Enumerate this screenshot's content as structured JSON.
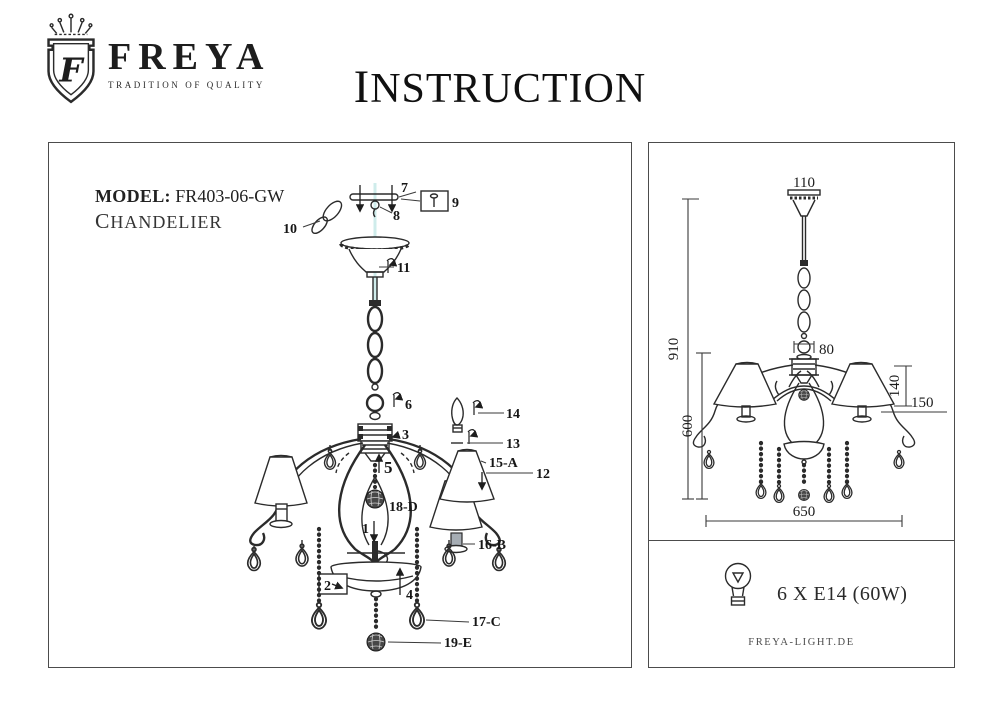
{
  "brand": {
    "monogram": "F",
    "name": "FREYA",
    "tagline": "TRADITION OF QUALITY"
  },
  "title": "INSTRUCTION",
  "product": {
    "model_label": "MODEL:",
    "model_value": "FR403-06-GW",
    "type": "CHANDELIER"
  },
  "exploded_view": {
    "parts": {
      "p1": "1",
      "p2": "2",
      "p3": "3",
      "p4": "4",
      "p5": "5",
      "p6": "6",
      "p7": "7",
      "p8": "8",
      "p9": "9",
      "p10": "10",
      "p11": "11",
      "p12": "12",
      "p13": "13",
      "p14": "14",
      "p15a": "15-A",
      "p16b": "16-B",
      "p17c": "17-C",
      "p18d": "18-D",
      "p19e": "19-E"
    }
  },
  "dimension_view": {
    "canopy_diameter": "110",
    "overall_height": "910",
    "hub_width": "80",
    "shade_height": "140",
    "shade_diameter": "150",
    "body_height": "600",
    "overall_diameter": "650"
  },
  "spec": {
    "bulb_icon": "bulb-icon",
    "bulbs": "6 X E14 (60W)",
    "website": "FREYA-LIGHT.DE"
  },
  "colors": {
    "ink": "#2b2b2b",
    "panel_border": "#4c4c4c",
    "center_guide": "#cfeceb",
    "muted": "#4b4b4b"
  }
}
